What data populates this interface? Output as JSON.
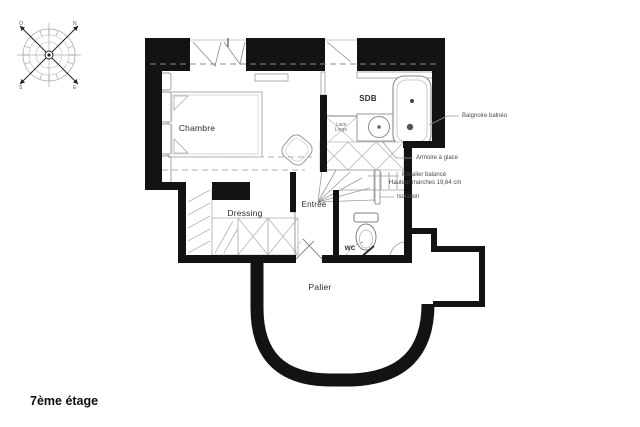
{
  "title": "7ème étage",
  "compass": {
    "north": "N",
    "south": "S",
    "east": "E",
    "west": "O"
  },
  "rooms": {
    "chambre": "Chambre",
    "sdb": "SDB",
    "dressing": "Dressing",
    "entree": "Entrée",
    "wc": "WC",
    "palier": "Palier"
  },
  "fixtures": {
    "lave_linge_line1": "Lave",
    "lave_linge_line2": "Linge"
  },
  "annotations": {
    "baignoire": "Baignoire balnéo",
    "armoire": "Armoire à glace",
    "escalier": "Escalier balancé",
    "hauteur_marches": "Hauteur marches 19,64 cm",
    "isolation": "Isolation"
  },
  "colors": {
    "wall": "#131313",
    "furniture_line": "#9a9a9a",
    "light_line": "#c4c4c4",
    "label_text": "#4a4a4a",
    "background": "#ffffff"
  }
}
